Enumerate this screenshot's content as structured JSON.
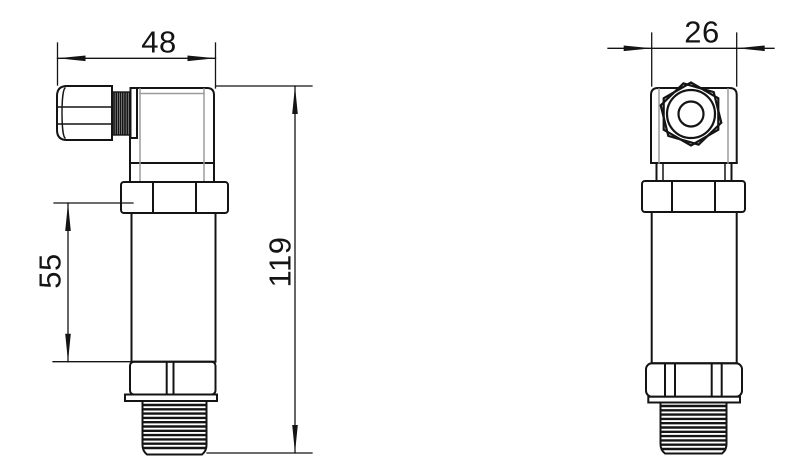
{
  "colors": {
    "background": "#ffffff",
    "line": "#141414"
  },
  "dimensions": {
    "side_top_width": "48",
    "side_body_length": "55",
    "side_overall_height": "119",
    "front_top_width": "26"
  }
}
